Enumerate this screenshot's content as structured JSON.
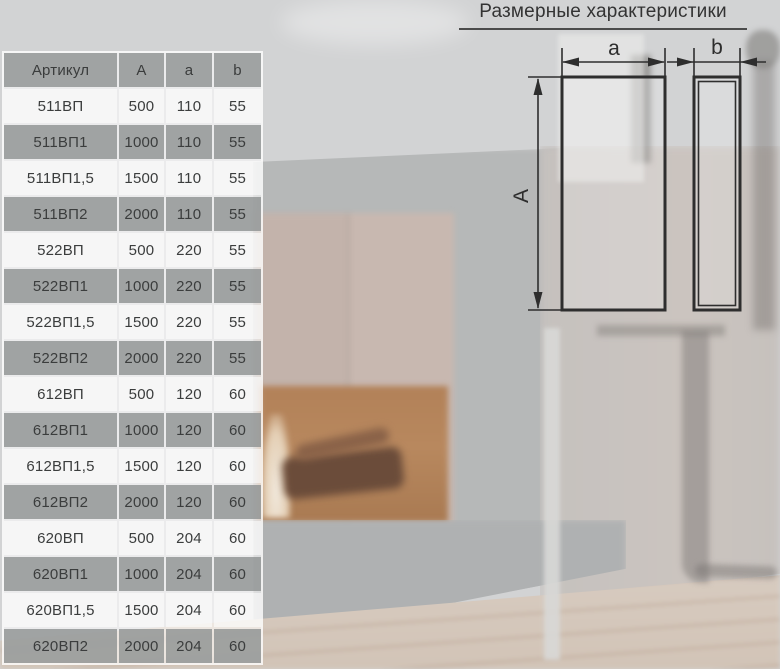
{
  "header": {
    "title": "Размерные характеристики"
  },
  "table": {
    "columns": [
      "Артикул",
      "A",
      "a",
      "b"
    ],
    "rows": [
      [
        "511ВП",
        "500",
        "110",
        "55"
      ],
      [
        "511ВП1",
        "1000",
        "110",
        "55"
      ],
      [
        "511ВП1,5",
        "1500",
        "110",
        "55"
      ],
      [
        "511ВП2",
        "2000",
        "110",
        "55"
      ],
      [
        "522ВП",
        "500",
        "220",
        "55"
      ],
      [
        "522ВП1",
        "1000",
        "220",
        "55"
      ],
      [
        "522ВП1,5",
        "1500",
        "220",
        "55"
      ],
      [
        "522ВП2",
        "2000",
        "220",
        "55"
      ],
      [
        "612ВП",
        "500",
        "120",
        "60"
      ],
      [
        "612ВП1",
        "1000",
        "120",
        "60"
      ],
      [
        "612ВП1,5",
        "1500",
        "120",
        "60"
      ],
      [
        "612ВП2",
        "2000",
        "120",
        "60"
      ],
      [
        "620ВП",
        "500",
        "204",
        "60"
      ],
      [
        "620ВП1",
        "1000",
        "204",
        "60"
      ],
      [
        "620ВП1,5",
        "1500",
        "204",
        "60"
      ],
      [
        "620ВП2",
        "2000",
        "204",
        "60"
      ]
    ]
  },
  "diagram": {
    "label_height": "A",
    "label_front_width": "a",
    "label_side_width": "b"
  },
  "colors": {
    "row_gray": "#9C9E9E",
    "row_light": "#ECEEEF",
    "table_text": "#3B3D3D",
    "drawing_line": "#2E2E2E",
    "title_text": "#333333",
    "fire_accent": "#B8885E"
  }
}
